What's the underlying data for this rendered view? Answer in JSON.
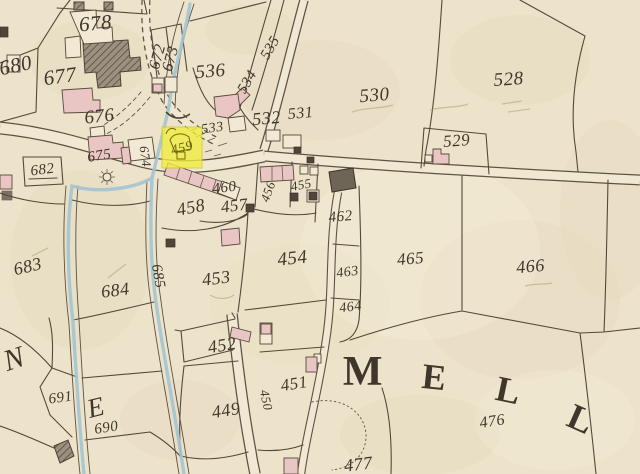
{
  "map": {
    "type": "historical-cadastral-map",
    "highlight": {
      "parcel": "459",
      "color": "#f2ee3e",
      "label_color": "#6e6a15"
    },
    "colors": {
      "paper": "#ece3ca",
      "ink": "#3f372b",
      "boundary_line": "#55483a",
      "water": "#a3c4d2",
      "building_pink": "#e9c5c4",
      "building_dark": "#4f453a",
      "road_fill": "#f0e8d2",
      "road_edge": "#5e5242",
      "highlight_yellow": "#f2ee3e"
    },
    "labels": [
      {
        "t": "678",
        "x": 96,
        "y": 30,
        "s": 21,
        "r": -5
      },
      {
        "t": "680",
        "x": 17,
        "y": 72,
        "s": 21,
        "r": -12
      },
      {
        "t": "677",
        "x": 61,
        "y": 83,
        "s": 21,
        "r": -8
      },
      {
        "t": "676",
        "x": 100,
        "y": 122,
        "s": 19,
        "r": -6
      },
      {
        "t": "672",
        "x": 162,
        "y": 58,
        "s": 16,
        "r": -74
      },
      {
        "t": "673",
        "x": 175,
        "y": 60,
        "s": 16,
        "r": -74
      },
      {
        "t": "536",
        "x": 211,
        "y": 77,
        "s": 19,
        "r": -5
      },
      {
        "t": "535",
        "x": 274,
        "y": 50,
        "s": 15,
        "r": -60
      },
      {
        "t": "534",
        "x": 251,
        "y": 84,
        "s": 15,
        "r": -60
      },
      {
        "t": "530",
        "x": 375,
        "y": 101,
        "s": 19,
        "r": -5
      },
      {
        "t": "528",
        "x": 509,
        "y": 85,
        "s": 19,
        "r": -4
      },
      {
        "t": "529",
        "x": 457,
        "y": 146,
        "s": 17,
        "r": -4
      },
      {
        "t": "533",
        "x": 213,
        "y": 132,
        "s": 14,
        "r": -8
      },
      {
        "t": "532",
        "x": 267,
        "y": 124,
        "s": 18,
        "r": -5
      },
      {
        "t": "531",
        "x": 301,
        "y": 118,
        "s": 16,
        "r": -5
      },
      {
        "t": "682",
        "x": 43,
        "y": 174,
        "s": 15,
        "r": -7
      },
      {
        "t": "675",
        "x": 100,
        "y": 160,
        "s": 15,
        "r": -9
      },
      {
        "t": "674",
        "x": 141,
        "y": 157,
        "s": 13,
        "r": 82
      },
      {
        "t": "459",
        "x": 183,
        "y": 152,
        "s": 14,
        "r": -14,
        "c": "#6e6a15",
        "n": "highlighted-parcel-label-459"
      },
      {
        "t": "460",
        "x": 225,
        "y": 192,
        "s": 15,
        "r": -7
      },
      {
        "t": "458",
        "x": 192,
        "y": 213,
        "s": 18,
        "r": -11
      },
      {
        "t": "457",
        "x": 235,
        "y": 211,
        "s": 17,
        "r": -7
      },
      {
        "t": "456",
        "x": 272,
        "y": 193,
        "s": 13,
        "r": -70
      },
      {
        "t": "455",
        "x": 302,
        "y": 189,
        "s": 13,
        "r": -11
      },
      {
        "t": "462",
        "x": 341,
        "y": 221,
        "s": 15,
        "r": -5
      },
      {
        "t": "463",
        "x": 348,
        "y": 276,
        "s": 14,
        "r": -7
      },
      {
        "t": "464",
        "x": 351,
        "y": 311,
        "s": 14,
        "r": -7
      },
      {
        "t": "465",
        "x": 411,
        "y": 264,
        "s": 17,
        "r": -5
      },
      {
        "t": "466",
        "x": 531,
        "y": 272,
        "s": 18,
        "r": -5
      },
      {
        "t": "683",
        "x": 29,
        "y": 272,
        "s": 18,
        "r": -13
      },
      {
        "t": "684",
        "x": 116,
        "y": 296,
        "s": 18,
        "r": -7
      },
      {
        "t": "685",
        "x": 154,
        "y": 277,
        "s": 15,
        "r": 80
      },
      {
        "t": "453",
        "x": 217,
        "y": 284,
        "s": 18,
        "r": -7
      },
      {
        "t": "454",
        "x": 293,
        "y": 264,
        "s": 19,
        "r": -6
      },
      {
        "t": "452",
        "x": 223,
        "y": 351,
        "s": 18,
        "r": -9
      },
      {
        "t": "451",
        "x": 295,
        "y": 389,
        "s": 17,
        "r": -9
      },
      {
        "t": "450",
        "x": 262,
        "y": 401,
        "s": 13,
        "r": 78
      },
      {
        "t": "449",
        "x": 227,
        "y": 416,
        "s": 18,
        "r": -9
      },
      {
        "t": "477",
        "x": 359,
        "y": 470,
        "s": 18,
        "r": -7
      },
      {
        "t": "476",
        "x": 493,
        "y": 426,
        "s": 16,
        "r": -9
      },
      {
        "t": "691",
        "x": 61,
        "y": 402,
        "s": 15,
        "r": -7
      },
      {
        "t": "690",
        "x": 107,
        "y": 432,
        "s": 15,
        "r": -9
      },
      {
        "t": "N",
        "x": 17,
        "y": 368,
        "s": 30,
        "r": -18,
        "n": "placename-letter-n"
      },
      {
        "t": "E",
        "x": 98,
        "y": 416,
        "s": 27,
        "r": -14,
        "n": "placename-letter-e-west"
      },
      {
        "t": "M",
        "x": 363,
        "y": 385,
        "s": 42,
        "r": 0,
        "b": true,
        "n": "placename-letter-m"
      },
      {
        "t": "E",
        "x": 433,
        "y": 389,
        "s": 36,
        "r": 6,
        "b": true,
        "n": "placename-letter-e"
      },
      {
        "t": "L",
        "x": 506,
        "y": 402,
        "s": 36,
        "r": 12,
        "b": true,
        "n": "placename-letter-l1"
      },
      {
        "t": "L",
        "x": 576,
        "y": 430,
        "s": 36,
        "r": 24,
        "b": true,
        "n": "placename-letter-l2"
      }
    ]
  }
}
